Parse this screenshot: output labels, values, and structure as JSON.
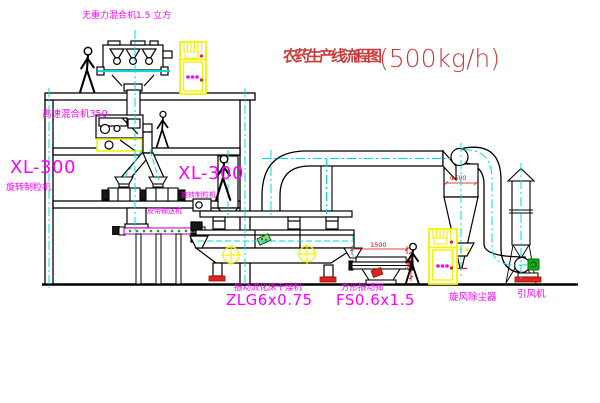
{
  "title": {
    "zh": "农药生产线流程图",
    "capacity": "(500kg/h)"
  },
  "labels": {
    "gravity_mixer": "无重力混合机1.5 立方",
    "high_speed_mixer": "高速混合机350",
    "granulator_left_model": "XL-300",
    "granulator_left_name": "旋转制粒机",
    "granulator_center_model": "XL-300",
    "granulator_center_name": "旋转制粒机",
    "belt_conveyor": "皮带输送机",
    "dryer_name": "振动流化床干燥机",
    "dryer_model": "ZLG6x0.75",
    "sieve_name": "方形振动筛",
    "sieve_model": "FS0.6x1.5",
    "cyclone": "旋风除尘器",
    "fan": "引风机"
  },
  "dimensions": {
    "sieve_width": "1500",
    "sieve_height": "545",
    "cyclone_inlet": "Φ500"
  },
  "colors": {
    "label_magenta": "#ff00ff",
    "title_red": "#c93b3b",
    "line_black": "#000000",
    "centerline_cyan": "#00e0e0",
    "highlight_yellow": "#f2f200",
    "dimension_red": "#e00000",
    "foot_red": "#e32219",
    "motor_green": "#17ab17"
  }
}
